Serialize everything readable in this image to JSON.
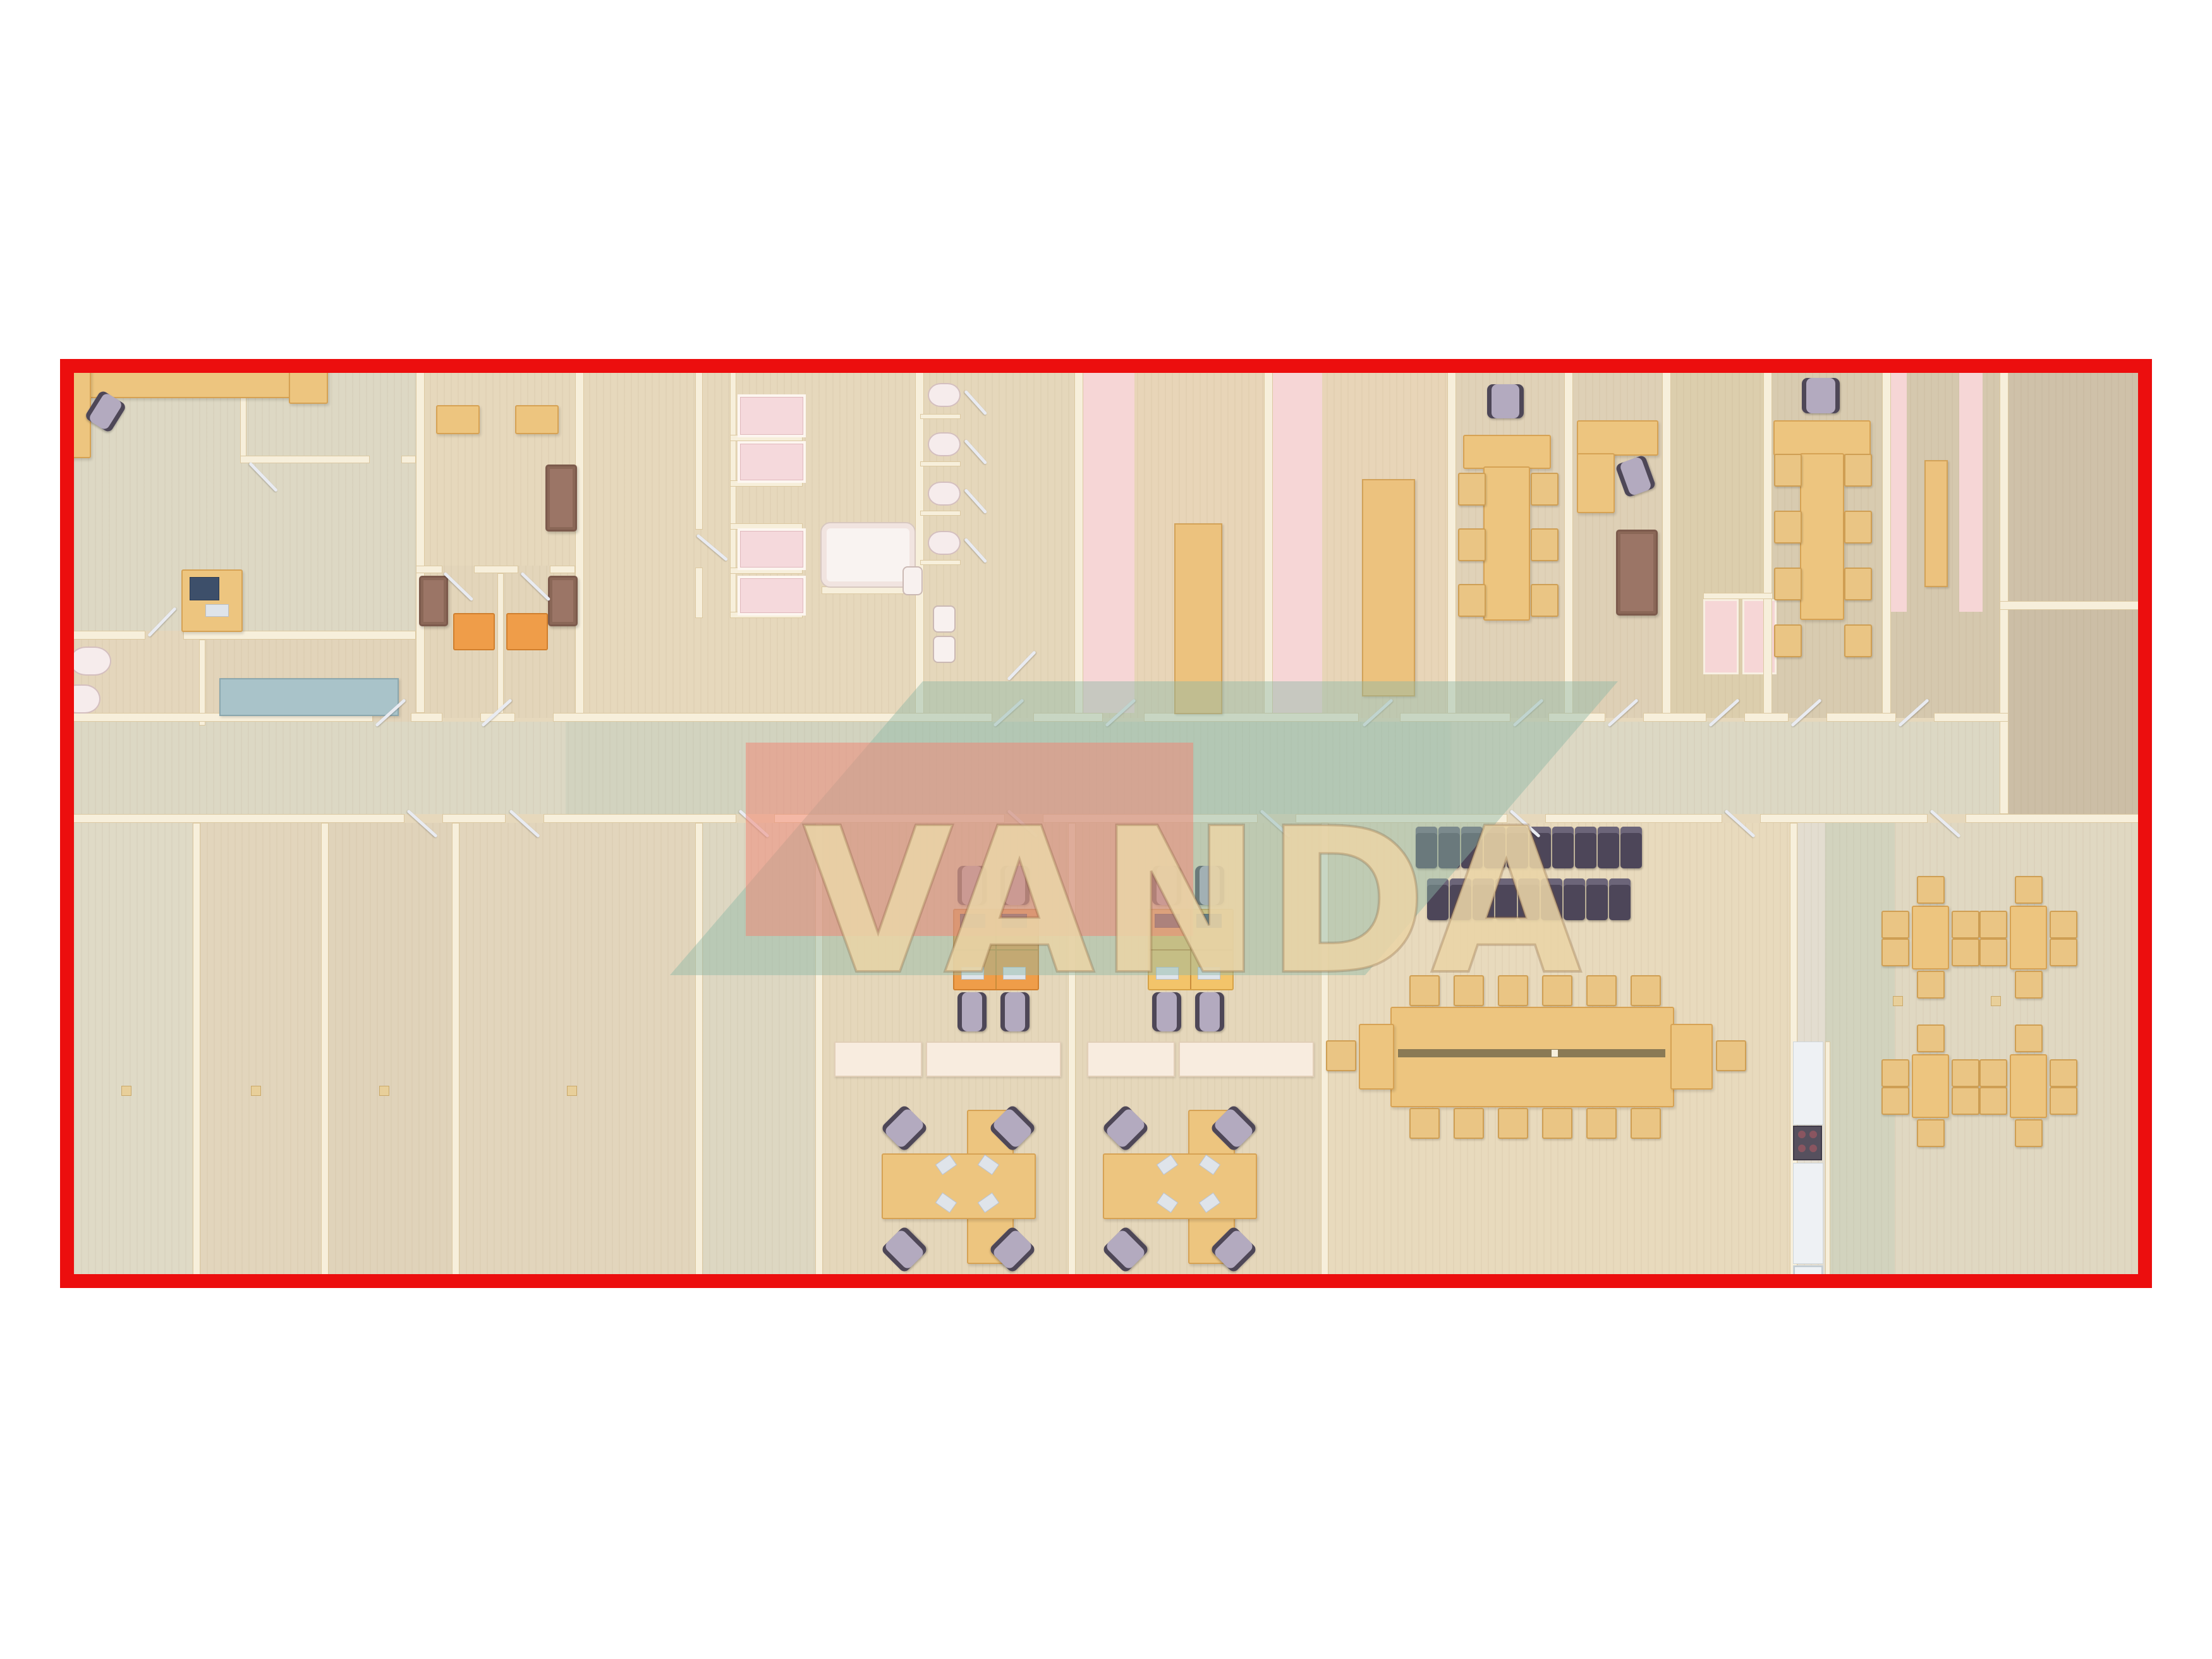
{
  "watermark": {
    "text": "VANDA",
    "letter_color": "#e9d4a6",
    "panel_pink": "#f28674",
    "panel_teal": "#8fb7a6"
  },
  "frame": {
    "border_color": "#ec0e0e"
  },
  "palette": {
    "floor_wood": "#e6d8bc",
    "wall_cream": "#f7efdb",
    "desk_tan": "#edc57f",
    "workstation_orange": "#ef9d49",
    "workstation_yellow": "#f3c46a",
    "sofa_brown": "#9b7566",
    "office_chair_lavender": "#b3aabf",
    "auditorium_chair_dark": "#4d4659",
    "sanitary_white": "#f8f1ef",
    "shower_pink": "#f5d9dc",
    "locker_mat_pink": "#f6d6d6",
    "table_teal": "#a9c3c9",
    "kitchen_white": "#eef1f4"
  }
}
